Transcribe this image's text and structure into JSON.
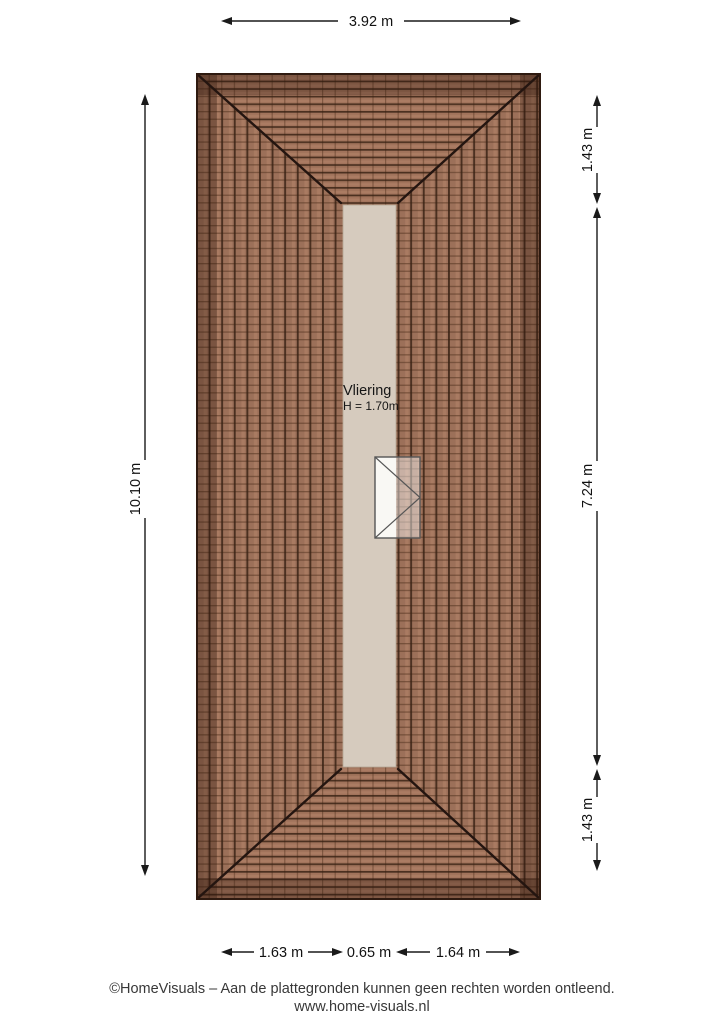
{
  "plan": {
    "room_label": "Vliering",
    "room_height": "H = 1.70m"
  },
  "dimensions": {
    "top_width": "3.92 m",
    "left_height": "10.10 m",
    "right_top": "1.43 m",
    "right_middle": "7.24 m",
    "right_bottom": "1.43 m",
    "bottom_left": "1.63 m",
    "bottom_middle": "0.65 m",
    "bottom_right": "1.64 m"
  },
  "footer": {
    "copyright_line": "©HomeVisuals – Aan de plattegronden kunnen geen rechten worden ontleend.",
    "website": "www.home-visuals.nl"
  },
  "colors": {
    "roof_tile_side": "#9c7059",
    "roof_tile_end": "#a1735b",
    "roof_edge_band": "#2a130a",
    "roof_line": "#241510",
    "floor_strip": "#d6cbbe",
    "annotation": "#1a1a1a"
  }
}
